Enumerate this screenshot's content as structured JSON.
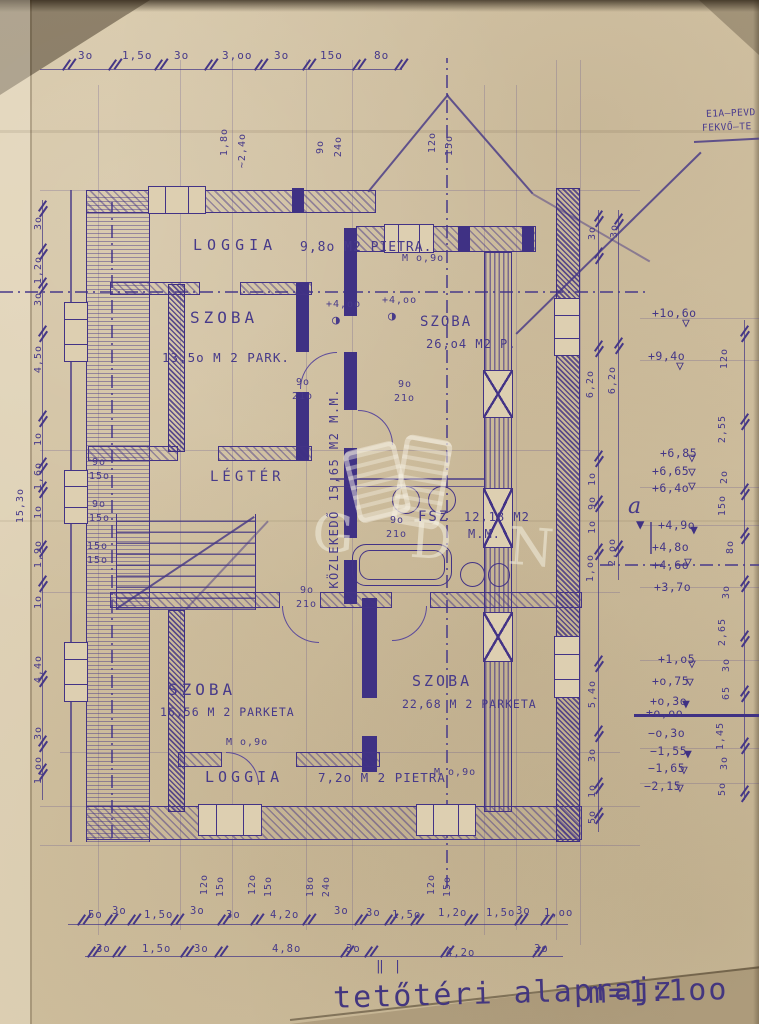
{
  "meta": {
    "sheet_title": "tetőtéri alaprajz",
    "scale": "m=1:1oo",
    "revision_marks": "‖ |"
  },
  "note": {
    "line1": "E1A–PEVD",
    "line2": "FEKVŐ–TE"
  },
  "watermark": {
    "text": "G D N"
  },
  "icons": {
    "tri_open": "▽",
    "tri_filled": "▼",
    "level_point": "◑",
    "section_flag": "▼"
  },
  "section_marker": "a",
  "rooms": {
    "loggia_top": {
      "name": "LOGGIA",
      "area": "9,8o M2 PIETRA."
    },
    "szoba_tl": {
      "name": "SZOBA",
      "area": "13,5o M 2 PARK."
    },
    "szoba_tr": {
      "name": "SZOBA",
      "area": "26,o4 M2 P."
    },
    "kozlekedo": {
      "name": "KÖZLEKEDŐ  15,65 M2 M.M."
    },
    "legter": {
      "name": "LÉGTÉR"
    },
    "fsz": {
      "name": "FSZ",
      "area": "12,18 M2",
      "mat": "M.M."
    },
    "szoba_bl": {
      "name": "SZOBA",
      "area": "16,56 M 2 PARKETA"
    },
    "szoba_br": {
      "name": "SZOBA",
      "area": "22,68 M 2 PARKETA"
    },
    "loggia_bottom": {
      "name": "LOGGIA",
      "area": "7,2o M 2 PIETRA"
    }
  },
  "doors": {
    "d1": "M o,9o",
    "d2": "M o,9o",
    "d3": "M o,9o"
  },
  "levels": {
    "p1": "+4,oo",
    "p2": "+4,oo"
  },
  "elevations": [
    "+1o,6o",
    "+9,4o",
    "+6,85",
    "+6,65",
    "+6,4o",
    "+4,9o",
    "+4,8o",
    "+4,6o",
    "+3,7o",
    "+1,o5",
    "+o,75",
    "+o,3o",
    "±o,oo",
    "−o,3o",
    "−1,55",
    "−1,65",
    "−2,15"
  ],
  "dims": {
    "top": [
      "3o",
      "1,5o",
      "3o",
      "3,oo",
      "3o",
      "15o",
      "8o"
    ],
    "top_rot": [
      "1,8o",
      "~2,4o",
      "9o",
      "24o",
      "12o",
      "15o"
    ],
    "left": [
      "3o",
      "1,2o",
      "3o",
      "4,5o",
      "1o",
      "1,6o",
      "1o",
      "15,3o",
      "1,9o",
      "1o",
      "4,4o",
      "3o",
      "1,oo"
    ],
    "left_inner": [
      "9o",
      "15o",
      "9o",
      "15o",
      "15o",
      "15o"
    ],
    "right": [
      "3o",
      "3o",
      "6,2o",
      "6,2o",
      "1o",
      "9o",
      "1o",
      "2,oo",
      "1,oo",
      "5,4o",
      "3o",
      "1o",
      "5o"
    ],
    "far_right": [
      "12o",
      "2,55",
      "2o",
      "15o",
      "8o",
      "3o",
      "2,65",
      "3o",
      "65",
      "1,45",
      "3o",
      "5o"
    ],
    "door": [
      "9o",
      "21o"
    ],
    "bottom_win": [
      "12o",
      "15o",
      "12o",
      "15o",
      "18o",
      "24o",
      "12o",
      "15o"
    ],
    "bottom1": [
      "5o",
      "3o",
      "1,5o",
      "3o",
      "3o",
      "4,2o",
      "3o",
      "3o",
      "1,5o",
      "1,2o",
      "1,5o",
      "3o",
      "1,oo"
    ],
    "bottom2": [
      "3o",
      "1,5o",
      "3o",
      "4,8o",
      "3o",
      "4,2o",
      "3o"
    ]
  }
}
